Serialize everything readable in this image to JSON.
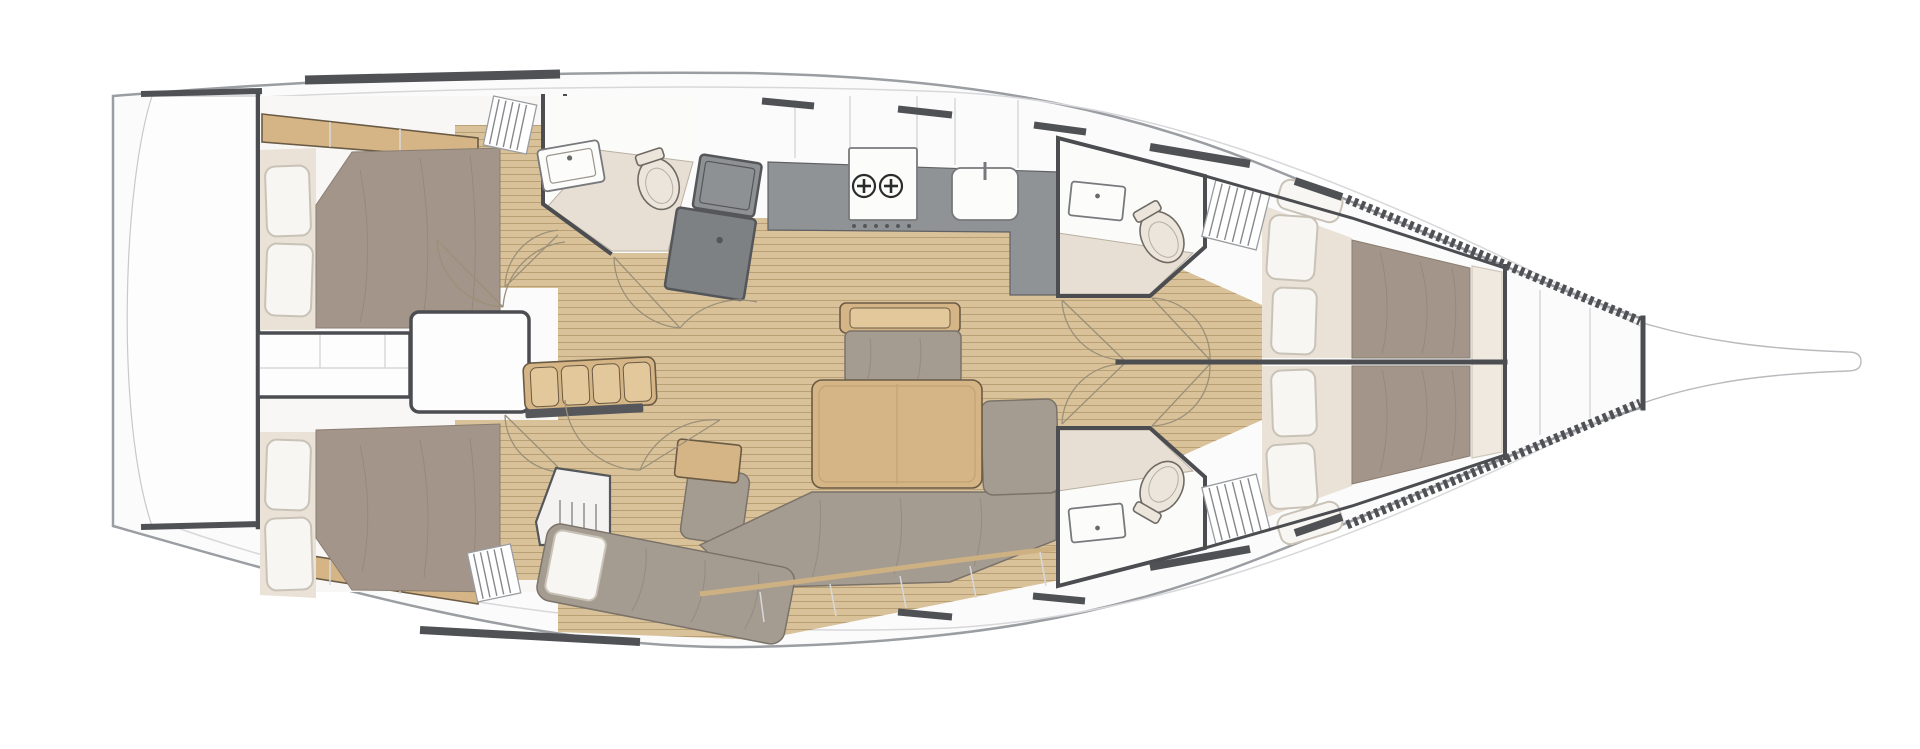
{
  "meta": {
    "title": "Sailing yacht interior layout plan, top view, bow to the right",
    "diagram_type": "boat floor plan",
    "text_on_image": "none"
  },
  "colors": {
    "background": "#ffffff",
    "hull_fill": "#fbfbfc",
    "hull_outline": "#9a9da1",
    "deck_line": "#d8d8db",
    "wall": "#4b4d50",
    "hardware": "#4f5154",
    "wood_floor": "#d9c29a",
    "wood_plank_line": "#b89f74",
    "wood_furniture": "#d5b586",
    "wood_furniture_edge": "#6b5b44",
    "mattress": "#a3958a",
    "mattress_crease": "#8f8275",
    "sofa": "#a49b91",
    "cushion_cream": "#eae2d6",
    "pillow": "#f7f6f3",
    "pillow_edge": "#c9c2b6",
    "counter": "#909396",
    "fixture_white": "#fcfcfb",
    "fixture_cream": "#ece5db",
    "shower_floor": "#e7dfd3",
    "white_panel": "#fdfdfe",
    "arc": "#9b9078"
  },
  "boat": {
    "orientation": "bow-right",
    "type": "monohull sailing yacht",
    "cabins": 4,
    "heads": 3
  },
  "rooms": {
    "transom": {
      "label": "Transom / swim platform"
    },
    "aft_cabin_port": {
      "label": "Aft cabin port side with double berth and two pillows"
    },
    "aft_cabin_starboard": {
      "label": "Aft cabin starboard side with double berth and two pillows"
    },
    "engine_box": {
      "label": "Engine compartment and companionway base between aft cabins"
    },
    "aft_head": {
      "label": "Aft head with basin, toilet and shower floor"
    },
    "companionway": {
      "label": "Companionway steps"
    },
    "galley": {
      "label": "Galley with two-burner stove and sink"
    },
    "salon": {
      "label": "Salon with dinette table, U-sofa, bench, slatted settee and chaise longue"
    },
    "fwd_head_port": {
      "label": "Forward head port side with basin and toilet"
    },
    "fwd_head_starboard": {
      "label": "Forward head starboard side with basin and toilet"
    },
    "fwd_cabin_port": {
      "label": "Forward cabin port side with double berth and two pillows"
    },
    "fwd_cabin_starboard": {
      "label": "Forward cabin starboard side with double berth and two pillows"
    },
    "forepeak": {
      "label": "Forepeak anchor locker"
    },
    "bowsprit": {
      "label": "Bowsprit"
    }
  },
  "fixtures": {
    "stove_burners": 2,
    "sinks": 3,
    "toilets": 3,
    "pillows_total": 8,
    "salon_table": 1,
    "companionway_steps": 1
  }
}
